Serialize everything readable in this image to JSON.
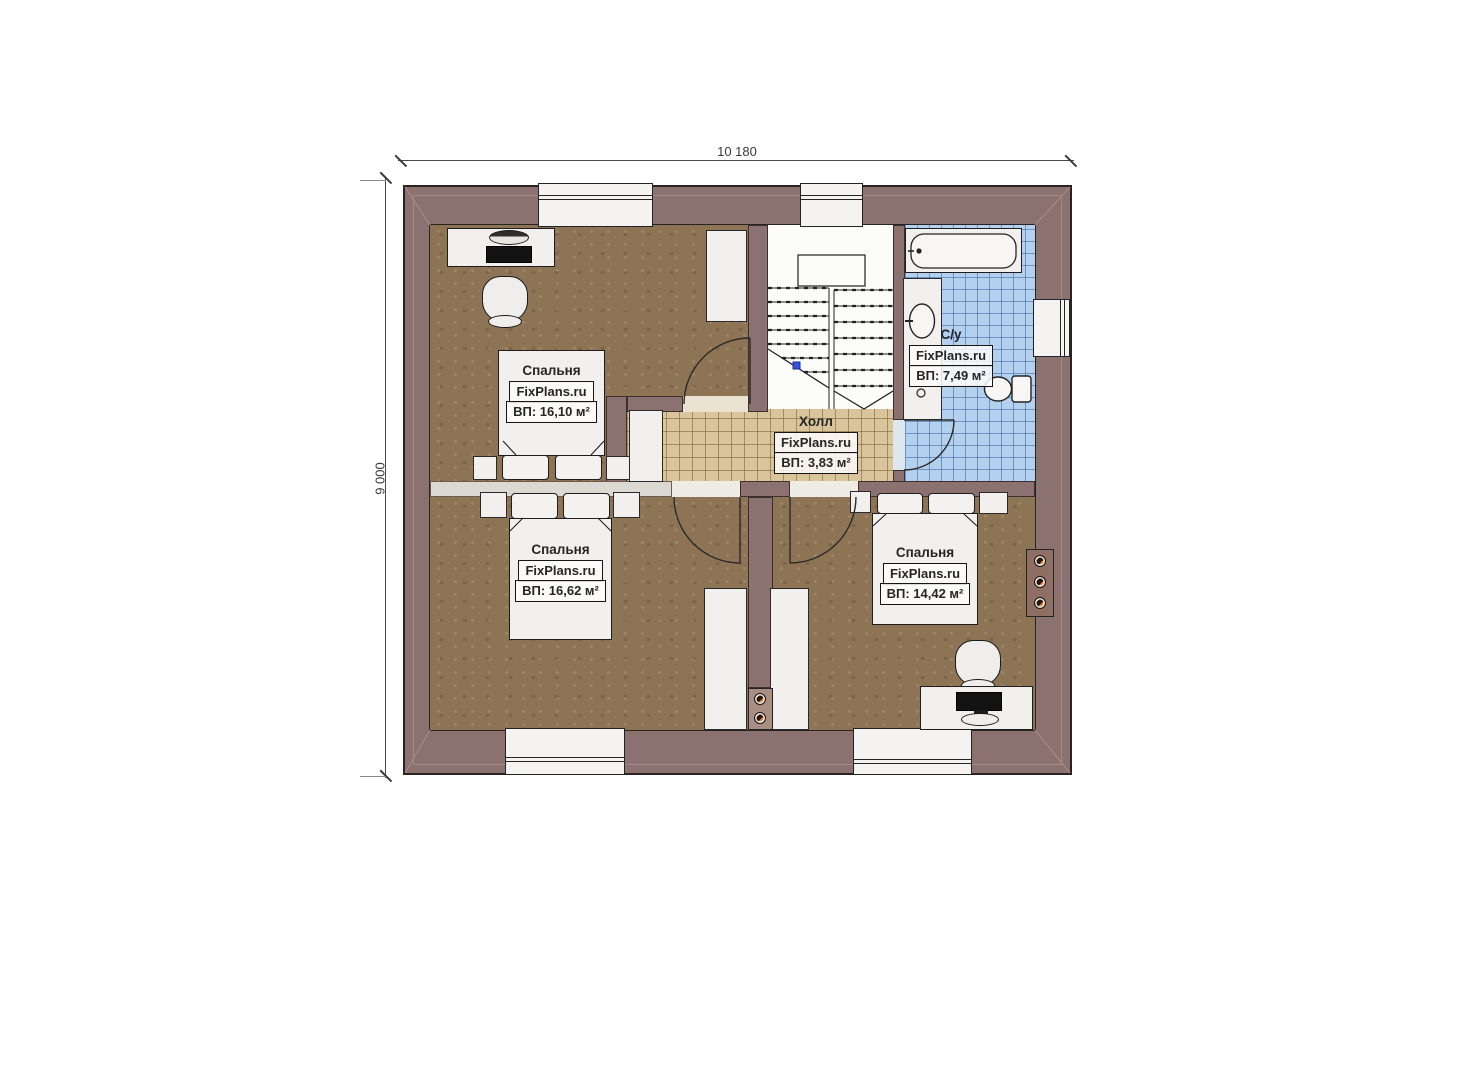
{
  "dimensions": {
    "width_label": "10 180",
    "height_label": "9 000"
  },
  "rooms": {
    "bedroom_top_left": {
      "name": "Спальня",
      "brand": "FixPlans.ru",
      "area": "ВП: 16,10 м²"
    },
    "bedroom_bottom_left": {
      "name": "Спальня",
      "brand": "FixPlans.ru",
      "area": "ВП: 16,62 м²"
    },
    "bedroom_bottom_right": {
      "name": "Спальня",
      "brand": "FixPlans.ru",
      "area": "ВП: 14,42 м²"
    },
    "hall": {
      "name": "Холл",
      "brand": "FixPlans.ru",
      "area": "ВП: 3,83 м²"
    },
    "bathroom": {
      "name": "С/у",
      "brand": "FixPlans.ru",
      "area": "ВП: 7,49 м²"
    }
  },
  "colors": {
    "wall": "#8b7170",
    "bedroom_floor": "#8d7454",
    "hall_floor": "#d9c49c",
    "bathroom_tile": "#b3d0ee",
    "stair_marker": "#3b4fd8",
    "flue_accent": "#e8813c"
  }
}
